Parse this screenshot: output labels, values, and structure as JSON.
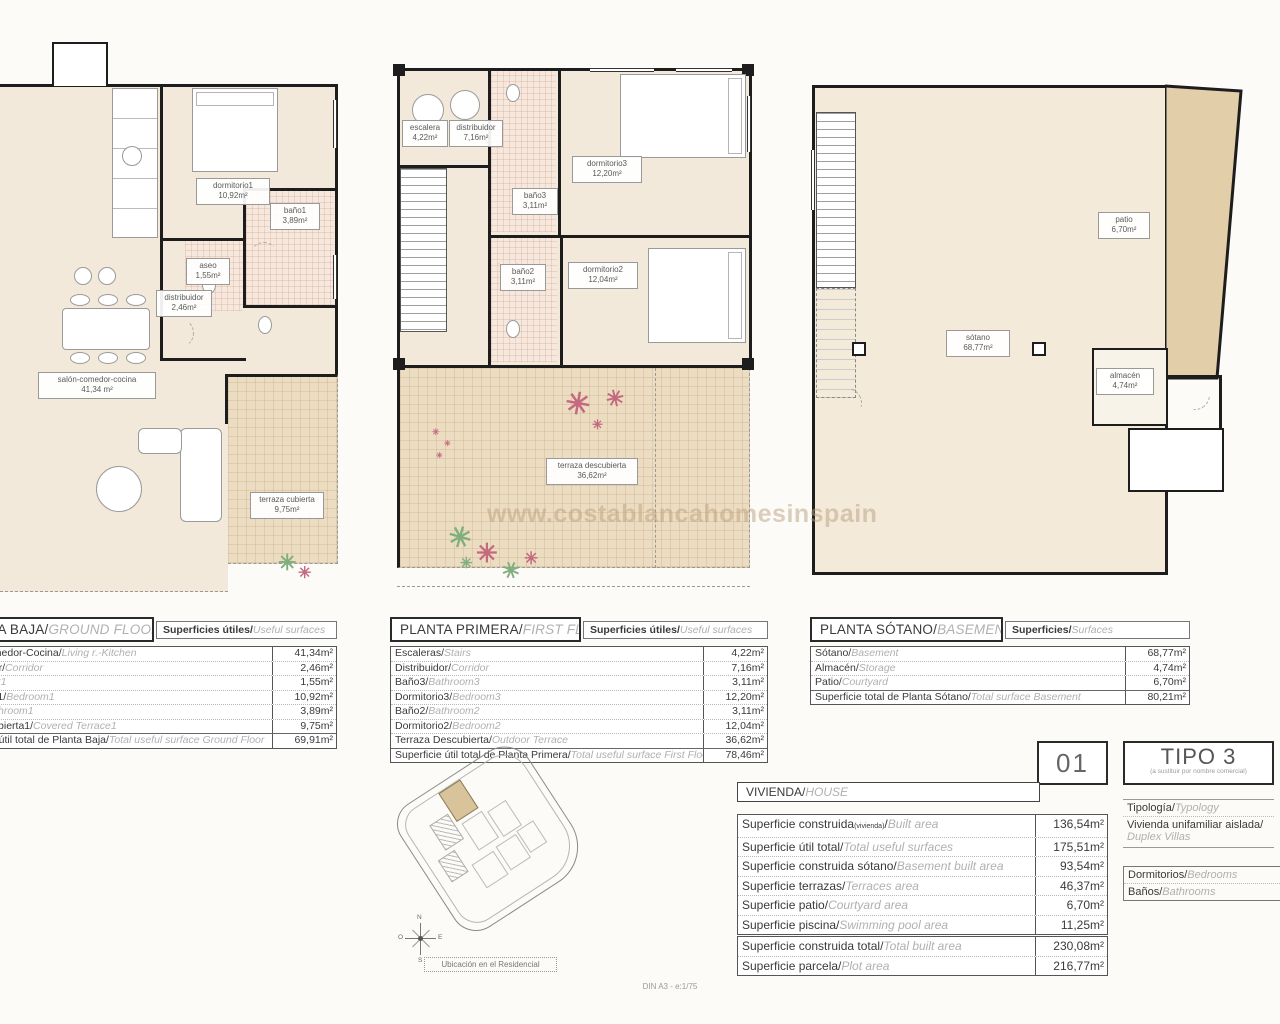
{
  "watermark": "www.costablancahomesinspain",
  "footer": {
    "scale_note": "DIN A3 - e:1/75"
  },
  "icons": {
    "flower": "✳"
  },
  "colors": {
    "wall": "#1d1d1d",
    "room_fill": "#f2e9da",
    "terrace_fill": "#ecdcc1",
    "patio_fill": "#e2cfa9",
    "bath_tile": "#f7e8dd",
    "flower_pink": "#c4697f",
    "flower_green": "#7fae7f",
    "watermark": "#b9a080"
  },
  "site": {
    "caption": "Ubicación en el Residencial",
    "compass": {
      "n": "N",
      "s": "S",
      "e": "E",
      "o": "O"
    }
  },
  "ground_floor": {
    "title_es": "PLANTA BAJA/",
    "title_en": "GROUND FLOOR",
    "surfaces_es": "Superficies útiles/",
    "surfaces_en": "Useful surfaces",
    "rooms": [
      {
        "name": "dormitorio1",
        "area": "10,92m²"
      },
      {
        "name": "baño1",
        "area": "3,89m²"
      },
      {
        "name": "aseo",
        "area": "1,55m²"
      },
      {
        "name": "distribuidor",
        "area": "2,46m²"
      },
      {
        "name": "salón-comedor-cocina",
        "area": "41,34 m²"
      },
      {
        "name": "terraza cubierta",
        "area": "9,75m²"
      }
    ],
    "rows": [
      {
        "es": "Salón-Comedor-Cocina/",
        "en": "Living r.-Kitchen",
        "value": "41,34m²"
      },
      {
        "es": "Distribuidor/",
        "en": "Corridor",
        "value": "2,46m²"
      },
      {
        "es": "Aseo/",
        "en": "Toilet1",
        "value": "1,55m²"
      },
      {
        "es": "Dormitorio1/",
        "en": "Bedroom1",
        "value": "10,92m²"
      },
      {
        "es": "Baño1/",
        "en": "Bathroom1",
        "value": "3,89m²"
      },
      {
        "es": "Terraza cubierta1/",
        "en": "Covered Terrace1",
        "value": "9,75m²"
      },
      {
        "es": "Superficie útil total de Planta Baja/",
        "en": "Total useful surface Ground Floor",
        "value": "69,91m²"
      }
    ]
  },
  "first_floor": {
    "title_es": "PLANTA PRIMERA/",
    "title_en": "FIRST FLOOR",
    "surfaces_es": "Superficies útiles/",
    "surfaces_en": "Useful surfaces",
    "rooms": [
      {
        "name": "escalera",
        "area": "4,22m²"
      },
      {
        "name": "distribuidor",
        "area": "7,16m²"
      },
      {
        "name": "baño3",
        "area": "3,11m²"
      },
      {
        "name": "dormitorio3",
        "area": "12,20m²"
      },
      {
        "name": "baño2",
        "area": "3,11m²"
      },
      {
        "name": "dormitorio2",
        "area": "12,04m²"
      },
      {
        "name": "terraza descubierta",
        "area": "36,62m²"
      }
    ],
    "rows": [
      {
        "es": "Escaleras/",
        "en": "Stairs",
        "value": "4,22m²"
      },
      {
        "es": "Distribuidor/",
        "en": "Corridor",
        "value": "7,16m²"
      },
      {
        "es": "Baño3/",
        "en": "Bathroom3",
        "value": "3,11m²"
      },
      {
        "es": "Dormitorio3/",
        "en": "Bedroom3",
        "value": "12,20m²"
      },
      {
        "es": "Baño2/",
        "en": "Bathroom2",
        "value": "3,11m²"
      },
      {
        "es": "Dormitorio2/",
        "en": "Bedroom2",
        "value": "12,04m²"
      },
      {
        "es": "Terraza Descubierta/",
        "en": "Outdoor Terrace",
        "value": "36,62m²"
      },
      {
        "es": "Superficie útil total de Planta Primera/",
        "en": "Total useful surface First Floor",
        "value": "78,46m²"
      }
    ]
  },
  "basement": {
    "title_es": "PLANTA SÓTANO/",
    "title_en": "BASEMENT",
    "surfaces_es": "Superficies/",
    "surfaces_en": "Surfaces",
    "rooms": [
      {
        "name": "sótano",
        "area": "68,77m²"
      },
      {
        "name": "patio",
        "area": "6,70m²"
      },
      {
        "name": "almacén",
        "area": "4,74m²"
      }
    ],
    "rows": [
      {
        "es": "Sótano/",
        "en": "Basement",
        "value": "68,77m²"
      },
      {
        "es": "Almacén/",
        "en": "Storage",
        "value": "4,74m²"
      },
      {
        "es": "Patio/",
        "en": "Courtyard",
        "value": "6,70m²"
      },
      {
        "es": "Superficie total de Planta Sótano/",
        "en": "Total surface Basement",
        "value": "80,21m²"
      }
    ]
  },
  "unit": {
    "number": "01",
    "type": "TIPO 3",
    "type_note": "(a sustituir por nombre comercial)",
    "typology_label_es": "Tipología/",
    "typology_label_en": "Typology",
    "typology_value_es": "Vivienda unifamiliar aislada/",
    "typology_value_en": "Duplex Villas",
    "bedrooms_es": "Dormitorios/",
    "bedrooms_en": "Bedrooms",
    "bathrooms_es": "Baños/",
    "bathrooms_en": "Bathrooms"
  },
  "house": {
    "title_es": "VIVIENDA/",
    "title_en": "HOUSE",
    "rows": [
      {
        "es": "Superficie construida",
        "es_sub": "(vivienda)",
        "slash": "/",
        "en": "Built area",
        "value": "136,54m²"
      },
      {
        "es": "Superficie útil total/",
        "en": "Total useful surfaces",
        "value": "175,51m²"
      },
      {
        "es": "Superficie construida sótano/",
        "en": "Basement built area",
        "value": "93,54m²"
      },
      {
        "es": "Superficie terrazas/",
        "en": "Terraces area",
        "value": "46,37m²"
      },
      {
        "es": "Superficie patio/",
        "en": "Courtyard area",
        "value": "6,70m²"
      },
      {
        "es": "Superficie piscina/",
        "en": "Swimming pool area",
        "value": "11,25m²"
      }
    ],
    "totals": [
      {
        "es": "Superficie construida total/",
        "en": "Total built area",
        "value": "230,08m²"
      },
      {
        "es": "Superficie parcela/",
        "en": "Plot area",
        "value": "216,77m²"
      }
    ]
  }
}
